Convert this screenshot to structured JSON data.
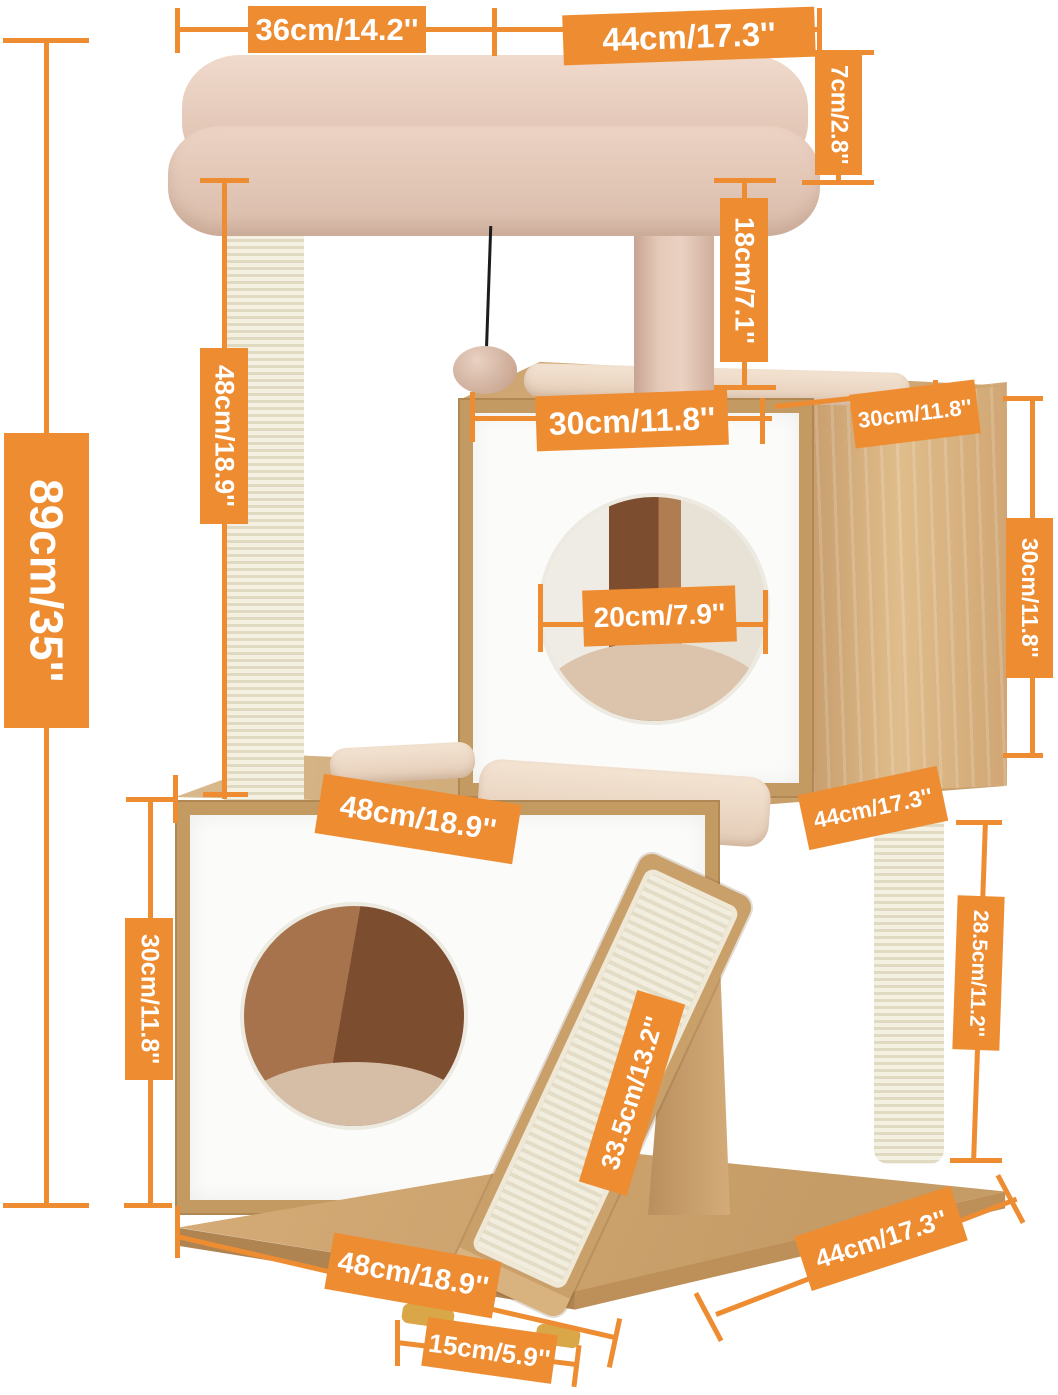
{
  "diagram_title": "Cat tree dimension diagram",
  "colors": {
    "accent": "#EE8C32",
    "label_text": "#FFFFFF"
  },
  "labels": {
    "top_left_width": "36cm/14.2''",
    "top_right_width": "44cm/17.3''",
    "perch_thickness": "7cm/2.8''",
    "perch_gap": "18cm/7.1''",
    "left_post_height": "48cm/18.9''",
    "total_height": "89cm/35''",
    "upper_condo_width": "30cm/11.8''",
    "upper_condo_depth": "30cm/11.8''",
    "hole_diameter": "20cm/7.9''",
    "upper_condo_height": "30cm/11.8''",
    "lower_shelf_width": "48cm/18.9''",
    "lower_shelf_depth": "44cm/17.3''",
    "lower_condo_height": "30cm/11.8''",
    "rear_post_height": "28.5cm/11.2''",
    "ramp_length": "33.5cm/13.2''",
    "base_width": "48cm/18.9''",
    "ramp_foot_offset": "15cm/5.9''",
    "base_depth": "44cm/17.3''"
  }
}
